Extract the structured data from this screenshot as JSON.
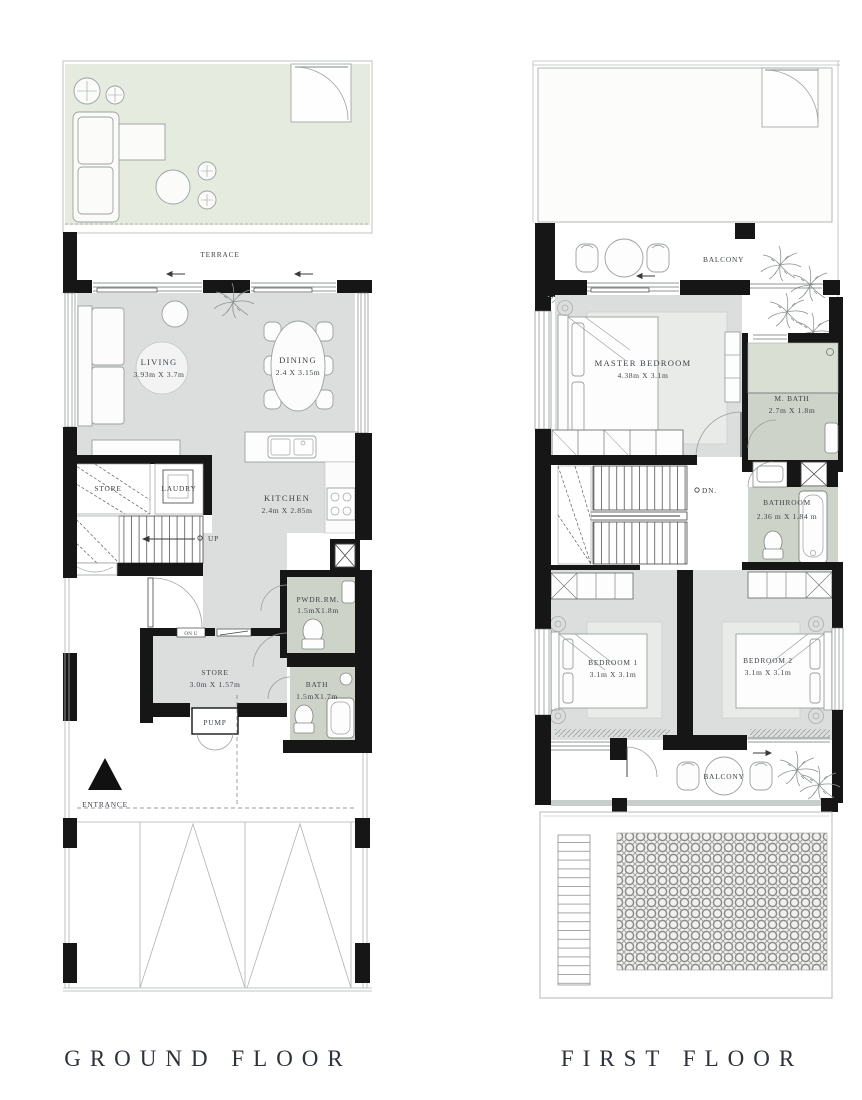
{
  "document": {
    "type": "residential floor plan sheet",
    "background": "#ffffff"
  },
  "colors": {
    "wall": "#161616",
    "floor_gray": "#dcdedd",
    "rug_light": "#e9ebe9",
    "terrace_green": "#e6ebe0",
    "bath_green": "#cdd3c8",
    "shower_green": "#dadfd4",
    "thin_line": "#9aa19e",
    "label_text": "#3f444a",
    "title_text": "#2e323c"
  },
  "gf": {
    "title": "GROUND FLOOR",
    "terrace": "TERRACE",
    "living_name": "LIVING",
    "living_dims": "3.93m X 3.7m",
    "dining_name": "DINING",
    "dining_dims": "2.4 X 3.15m",
    "kitchen_name": "KITCHEN",
    "kitchen_dims": "2.4m X 2.85m",
    "store1": "STORE",
    "laundry": "LAUDRY",
    "up": "UP",
    "onu": "ON U",
    "pwdr_name": "PWDR.RM.",
    "pwdr_dims": "1.5mX1.8m",
    "store2_name": "STORE",
    "store2_dims": "3.0m X 1.57m",
    "bath_name": "BATH",
    "bath_dims": "1.5mX1.7m",
    "pump": "PUMP",
    "entrance": "ENTRANCE"
  },
  "ff": {
    "title": "FIRST FLOOR",
    "balcony_top": "BALCONY",
    "master_name": "MASTER BEDROOM",
    "master_dims": "4.38m X 3.1m",
    "mbath_name": "M. BATH",
    "mbath_dims": "2.7m X 1.8m",
    "dn": "DN.",
    "bathroom_name": "BATHROOM",
    "bathroom_dims": "2.36 m X 1.84 m",
    "bed1_name": "BEDROOM 1",
    "bed1_dims": "3.1m X 3.1m",
    "bed2_name": "BEDROOM 2",
    "bed2_dims": "3.1m X 3.1m",
    "balcony_bottom": "BALCONY"
  }
}
